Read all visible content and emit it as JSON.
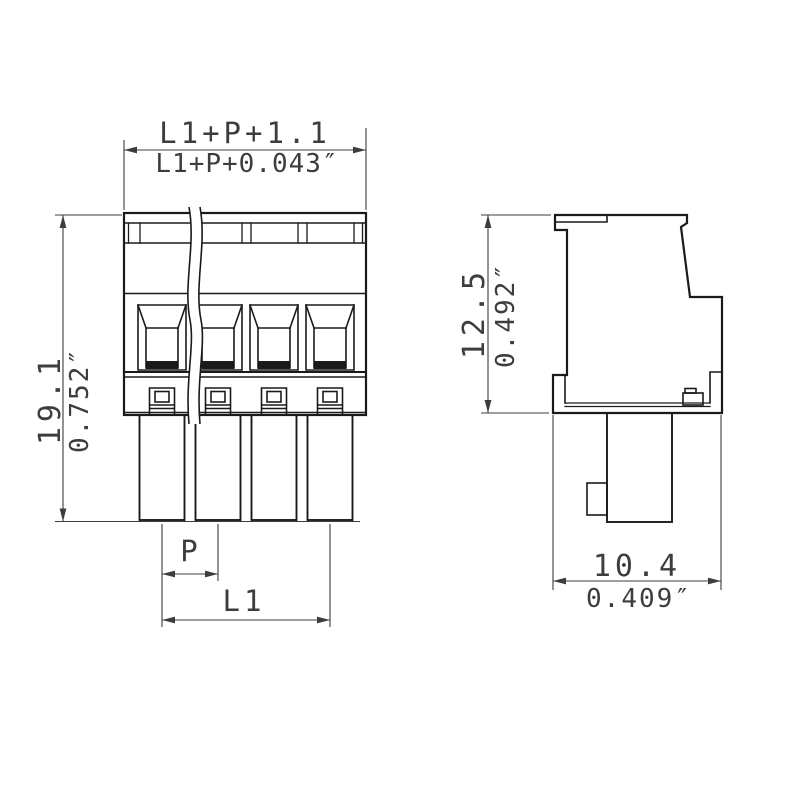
{
  "views": {
    "front": {
      "dims": {
        "width_metric": "L1+P+1.1",
        "width_inch": "L1+P+0.043″",
        "height_metric": "19.1",
        "height_inch": "0.752″",
        "pitch": "P",
        "length": "L1"
      }
    },
    "side": {
      "dims": {
        "height_metric": "12.5",
        "height_inch": "0.492″",
        "depth_metric": "10.4",
        "depth_inch": "0.409″"
      }
    }
  },
  "colors": {
    "object_line": "#1a1a1a",
    "dimension_line": "#3d3d3d",
    "background": "#ffffff"
  }
}
